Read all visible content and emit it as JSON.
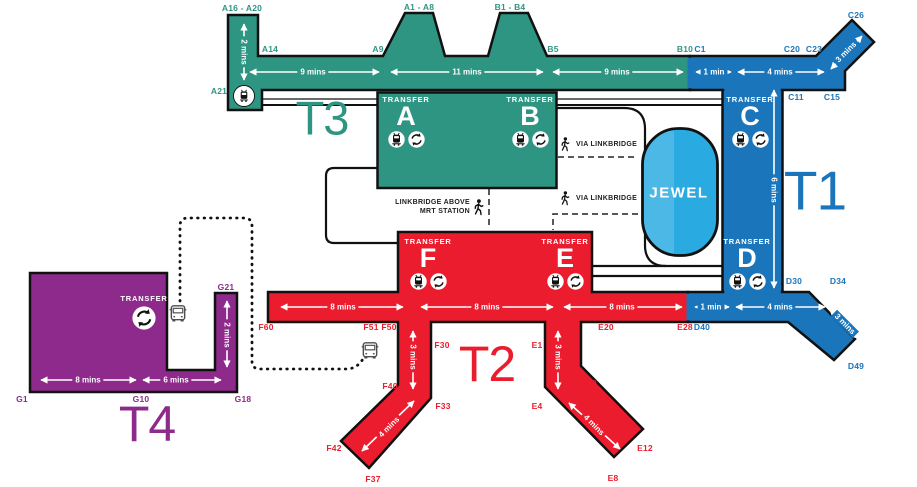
{
  "terminals": {
    "t3": {
      "label": "T3",
      "color": "#2E9583"
    },
    "t1": {
      "label": "T1",
      "color": "#1B75BB"
    },
    "t2": {
      "label": "T2",
      "color": "#EB1C2D"
    },
    "t4": {
      "label": "T4",
      "color": "#8E2A8C"
    }
  },
  "jewel": {
    "label": "JEWEL",
    "color": "#29ABE2"
  },
  "transfers": {
    "a": {
      "heading": "TRANSFER",
      "letter": "A",
      "icons": [
        "skytrain-icon",
        "transfer-icon"
      ]
    },
    "b": {
      "heading": "TRANSFER",
      "letter": "B",
      "icons": [
        "skytrain-icon",
        "transfer-icon"
      ]
    },
    "c": {
      "heading": "TRANSFER",
      "letter": "C",
      "icons": [
        "skytrain-icon",
        "transfer-icon"
      ]
    },
    "d": {
      "heading": "TRANSFER",
      "letter": "D",
      "icons": [
        "skytrain-icon",
        "transfer-icon"
      ]
    },
    "e": {
      "heading": "TRANSFER",
      "letter": "E",
      "icons": [
        "skytrain-icon",
        "transfer-icon"
      ]
    },
    "f": {
      "heading": "TRANSFER",
      "letter": "F",
      "icons": [
        "skytrain-icon",
        "transfer-icon"
      ]
    },
    "t4": {
      "heading": "TRANSFER",
      "icons": [
        "transfer-icon"
      ]
    }
  },
  "gates": {
    "t3": [
      "A16 - A20",
      "A14",
      "A9",
      "A1 - A8",
      "B1 - B4",
      "B5",
      "B10",
      "A21"
    ],
    "t1": [
      "C1",
      "C20",
      "C23",
      "C26",
      "C11",
      "C15",
      "D30",
      "D34",
      "D40",
      "D46",
      "D49"
    ],
    "t2": [
      "F60",
      "F51",
      "F50",
      "F30",
      "F40",
      "F33",
      "F42",
      "F37",
      "E20",
      "E28",
      "E1",
      "E10",
      "E4",
      "E12",
      "E8"
    ],
    "t4": [
      "G21",
      "G1",
      "G10",
      "G18"
    ]
  },
  "times": {
    "t3_pier": "2 mins",
    "t3_a": "9 mins",
    "t3_ab": "11 mins",
    "t3_b": "9 mins",
    "t1_c_link": "1 min",
    "t1_c": "4 mins",
    "t1_c_pier": "3 mins",
    "t1_spine": "6 mins",
    "t1_d_link": "1 min",
    "t1_d": "4 mins",
    "t1_d_pier": "3 mins",
    "t2_f": "8 mins",
    "t2_fe": "8 mins",
    "t2_e": "8 mins",
    "t2_f_pier": "3 mins",
    "t2_f_diag": "4 mins",
    "t2_e_pier": "3 mins",
    "t2_e_diag": "4 mins",
    "t4_west": "8 mins",
    "t4_east": "6 mins",
    "t4_pier": "2 mins"
  },
  "notes": {
    "linkbridge_mrt_line1": "LINKBRIDGE ABOVE",
    "linkbridge_mrt_line2": "MRT STATION",
    "via_linkbridge_top": "VIA LINKBRIDGE",
    "via_linkbridge_bottom": "VIA LINKBRIDGE"
  },
  "icons": {
    "skytrain": "skytrain-icon",
    "transfer": "transfer-icon",
    "bus": "bus-icon",
    "walk": "walking-person-icon"
  }
}
